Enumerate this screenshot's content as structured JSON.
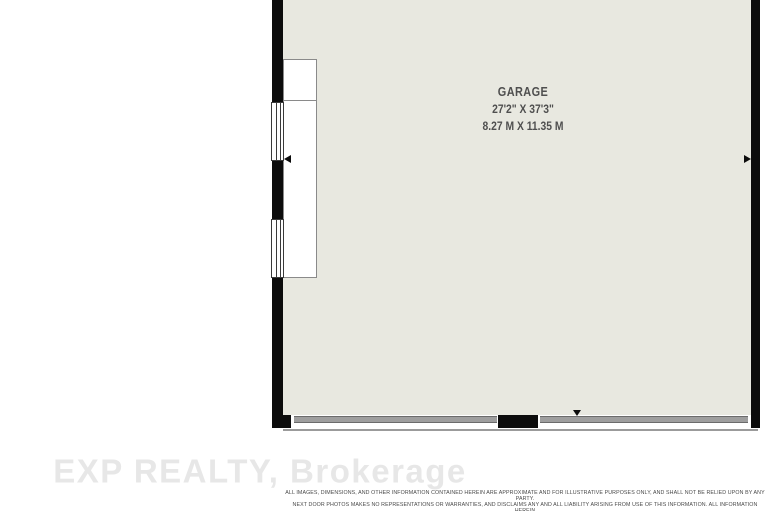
{
  "floor_plan": {
    "room": {
      "name": "GARAGE",
      "dimensions_imperial": "27'2\" X 37'3\"",
      "dimensions_metric": "8.27 M X 11.35 M"
    },
    "features": {
      "windows_left_wall": 2,
      "garage_doors_bottom_wall": 2
    },
    "colors": {
      "floor_fill": "#e8e8e0",
      "wall": "#0c0c0c",
      "garage_door_panel": "#9e9e9e",
      "garage_door_edge": "#6b6b6b",
      "exterior_face_line": "#9b9b9b"
    }
  },
  "branding": {
    "watermark": "EXP REALTY, Brokerage"
  },
  "disclaimer": {
    "line1": "ALL IMAGES, DIMENSIONS, AND OTHER INFORMATION CONTAINED HEREIN ARE APPROXIMATE AND FOR ILLUSTRATIVE PURPOSES ONLY, AND SHALL NOT BE RELIED UPON BY ANY PARTY.",
    "line2": "NEXT DOOR PHOTOS MAKES NO REPRESENTATIONS OR WARRANTIES, AND DISCLAIMS ANY AND ALL LIABILITY ARISING FROM USE OF THIS INFORMATION. ALL INFORMATION HEREIN",
    "line3": "SHALL BE SUBJECT TO THE TERMS AND CONDITIONS FOUND AT NEXTDOORPHOTOS.COM/TC."
  }
}
